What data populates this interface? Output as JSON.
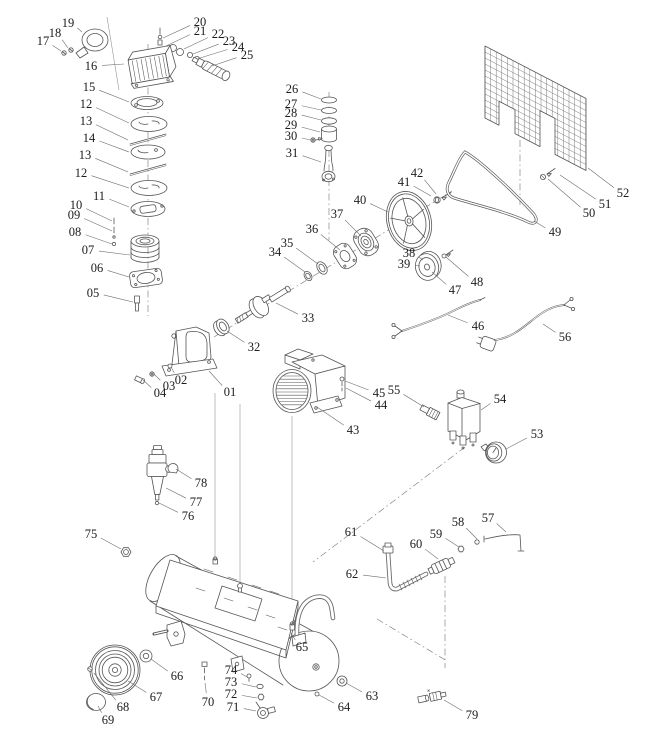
{
  "colors": {
    "background": "#ffffff",
    "line": "#555555",
    "label_text": "#1c1c1c",
    "construction_line": "#7e7e7e"
  },
  "diagram": {
    "labels": [
      {
        "text": "01",
        "x": 230,
        "y": 392,
        "tx": 209,
        "ty": 371
      },
      {
        "text": "02",
        "x": 181,
        "y": 380,
        "tx": 171,
        "ty": 367
      },
      {
        "text": "03",
        "x": 169,
        "y": 386,
        "tx": 154,
        "ty": 374
      },
      {
        "text": "04",
        "x": 160,
        "y": 393,
        "tx": 143,
        "ty": 380
      },
      {
        "text": "05",
        "x": 93,
        "y": 293,
        "tx": 133,
        "ty": 302
      },
      {
        "text": "06",
        "x": 97,
        "y": 268,
        "tx": 129,
        "ty": 277
      },
      {
        "text": "07",
        "x": 88,
        "y": 250,
        "tx": 130,
        "ty": 255
      },
      {
        "text": "08",
        "x": 75,
        "y": 232,
        "tx": 112,
        "ty": 244
      },
      {
        "text": "09",
        "x": 74,
        "y": 215,
        "tx": 112,
        "ty": 231
      },
      {
        "text": "10",
        "x": 76,
        "y": 205,
        "tx": 112,
        "ty": 221
      },
      {
        "text": "11",
        "x": 99,
        "y": 196,
        "tx": 129,
        "ty": 207
      },
      {
        "text": "12",
        "x": 81,
        "y": 173,
        "tx": 129,
        "ty": 188
      },
      {
        "text": "13",
        "x": 85,
        "y": 155,
        "tx": 128,
        "ty": 172
      },
      {
        "text": "14",
        "x": 89,
        "y": 138,
        "tx": 129,
        "ty": 152
      },
      {
        "text": "13",
        "x": 86,
        "y": 121,
        "tx": 128,
        "ty": 140
      },
      {
        "text": "12",
        "x": 86,
        "y": 104,
        "tx": 129,
        "ty": 123
      },
      {
        "text": "15",
        "x": 89,
        "y": 87,
        "tx": 129,
        "ty": 102
      },
      {
        "text": "16",
        "x": 91,
        "y": 66,
        "tx": 124,
        "ty": 64
      },
      {
        "text": "17",
        "x": 43,
        "y": 41,
        "tx": 61,
        "ty": 51
      },
      {
        "text": "18",
        "x": 55,
        "y": 33,
        "tx": 68,
        "ty": 48
      },
      {
        "text": "19",
        "x": 68,
        "y": 23,
        "tx": 82,
        "ty": 32
      },
      {
        "text": "20",
        "x": 200,
        "y": 22,
        "tx": 163,
        "ty": 38
      },
      {
        "text": "21",
        "x": 200,
        "y": 31,
        "tx": 166,
        "ty": 46
      },
      {
        "text": "22",
        "x": 218,
        "y": 34,
        "tx": 184,
        "ty": 49
      },
      {
        "text": "23",
        "x": 229,
        "y": 41,
        "tx": 193,
        "ty": 54
      },
      {
        "text": "24",
        "x": 238,
        "y": 47,
        "tx": 200,
        "ty": 58
      },
      {
        "text": "25",
        "x": 247,
        "y": 55,
        "tx": 212,
        "ty": 66
      },
      {
        "text": "26",
        "x": 292,
        "y": 89,
        "tx": 321,
        "ty": 99
      },
      {
        "text": "27",
        "x": 291,
        "y": 104,
        "tx": 321,
        "ty": 110
      },
      {
        "text": "28",
        "x": 291,
        "y": 113,
        "tx": 321,
        "ty": 120
      },
      {
        "text": "29",
        "x": 291,
        "y": 125,
        "tx": 320,
        "ty": 132
      },
      {
        "text": "30",
        "x": 291,
        "y": 136,
        "tx": 310,
        "ty": 140
      },
      {
        "text": "31",
        "x": 292,
        "y": 153,
        "tx": 321,
        "ty": 162
      },
      {
        "text": "32",
        "x": 254,
        "y": 347,
        "tx": 227,
        "ty": 331
      },
      {
        "text": "33",
        "x": 308,
        "y": 318,
        "tx": 276,
        "ty": 303
      },
      {
        "text": "34",
        "x": 275,
        "y": 252,
        "tx": 305,
        "ty": 272
      },
      {
        "text": "35",
        "x": 287,
        "y": 243,
        "tx": 318,
        "ty": 264
      },
      {
        "text": "36",
        "x": 312,
        "y": 229,
        "tx": 340,
        "ty": 250
      },
      {
        "text": "37",
        "x": 337,
        "y": 214,
        "tx": 361,
        "ty": 236
      },
      {
        "text": "38",
        "x": 409,
        "y": 253,
        "tx": 423,
        "ty": 260
      },
      {
        "text": "39",
        "x": 404,
        "y": 264,
        "tx": 420,
        "ty": 266
      },
      {
        "text": "40",
        "x": 360,
        "y": 200,
        "tx": 388,
        "ty": 212
      },
      {
        "text": "41",
        "x": 404,
        "y": 182,
        "tx": 431,
        "ty": 196
      },
      {
        "text": "42",
        "x": 417,
        "y": 173,
        "tx": 436,
        "ty": 194
      },
      {
        "text": "43",
        "x": 353,
        "y": 430,
        "tx": 317,
        "ty": 407
      },
      {
        "text": "44",
        "x": 381,
        "y": 405,
        "tx": 346,
        "ty": 388
      },
      {
        "text": "45",
        "x": 379,
        "y": 393,
        "tx": 345,
        "ty": 381
      },
      {
        "text": "46",
        "x": 478,
        "y": 326,
        "tx": 448,
        "ty": 315
      },
      {
        "text": "47",
        "x": 455,
        "y": 290,
        "tx": 432,
        "ty": 272
      },
      {
        "text": "48",
        "x": 477,
        "y": 282,
        "tx": 446,
        "ty": 257
      },
      {
        "text": "49",
        "x": 555,
        "y": 232,
        "tx": 534,
        "ty": 221
      },
      {
        "text": "50",
        "x": 589,
        "y": 213,
        "tx": 548,
        "ty": 179
      },
      {
        "text": "51",
        "x": 605,
        "y": 204,
        "tx": 560,
        "ty": 175
      },
      {
        "text": "52",
        "x": 623,
        "y": 193,
        "tx": 588,
        "ty": 168
      },
      {
        "text": "53",
        "x": 537,
        "y": 434,
        "tx": 506,
        "ty": 449
      },
      {
        "text": "54",
        "x": 500,
        "y": 399,
        "tx": 481,
        "ty": 410
      },
      {
        "text": "55",
        "x": 394,
        "y": 390,
        "tx": 424,
        "ty": 407
      },
      {
        "text": "56",
        "x": 565,
        "y": 337,
        "tx": 543,
        "ty": 324
      },
      {
        "text": "57",
        "x": 488,
        "y": 518,
        "tx": 506,
        "ty": 532
      },
      {
        "text": "58",
        "x": 458,
        "y": 522,
        "tx": 477,
        "ty": 539
      },
      {
        "text": "59",
        "x": 436,
        "y": 534,
        "tx": 459,
        "ty": 547
      },
      {
        "text": "60",
        "x": 416,
        "y": 544,
        "tx": 438,
        "ty": 559
      },
      {
        "text": "61",
        "x": 351,
        "y": 532,
        "tx": 384,
        "ty": 551
      },
      {
        "text": "62",
        "x": 352,
        "y": 574,
        "tx": 386,
        "ty": 578
      },
      {
        "text": "63",
        "x": 372,
        "y": 696,
        "tx": 346,
        "ty": 683
      },
      {
        "text": "64",
        "x": 344,
        "y": 707,
        "tx": 319,
        "ty": 695
      },
      {
        "text": "65",
        "x": 302,
        "y": 647,
        "tx": 291,
        "ty": 633
      },
      {
        "text": "66",
        "x": 177,
        "y": 676,
        "tx": 151,
        "ty": 659
      },
      {
        "text": "67",
        "x": 156,
        "y": 697,
        "tx": 128,
        "ty": 681
      },
      {
        "text": "68",
        "x": 123,
        "y": 707,
        "tx": 94,
        "ty": 673
      },
      {
        "text": "69",
        "x": 108,
        "y": 720,
        "tx": 98,
        "ty": 706
      },
      {
        "text": "70",
        "x": 208,
        "y": 702,
        "tx": 205,
        "ty": 683
      },
      {
        "text": "71",
        "x": 233,
        "y": 707,
        "tx": 256,
        "ty": 711
      },
      {
        "text": "72",
        "x": 231,
        "y": 694,
        "tx": 257,
        "ty": 698
      },
      {
        "text": "73",
        "x": 231,
        "y": 682,
        "tx": 256,
        "ty": 687
      },
      {
        "text": "74",
        "x": 231,
        "y": 670,
        "tx": 249,
        "ty": 678
      },
      {
        "text": "75",
        "x": 91,
        "y": 534,
        "tx": 121,
        "ty": 549
      },
      {
        "text": "76",
        "x": 188,
        "y": 516,
        "tx": 159,
        "ty": 503
      },
      {
        "text": "77",
        "x": 196,
        "y": 502,
        "tx": 166,
        "ty": 488
      },
      {
        "text": "78",
        "x": 201,
        "y": 483,
        "tx": 176,
        "ty": 469
      },
      {
        "text": "79",
        "x": 472,
        "y": 715,
        "tx": 444,
        "ty": 700
      }
    ]
  }
}
